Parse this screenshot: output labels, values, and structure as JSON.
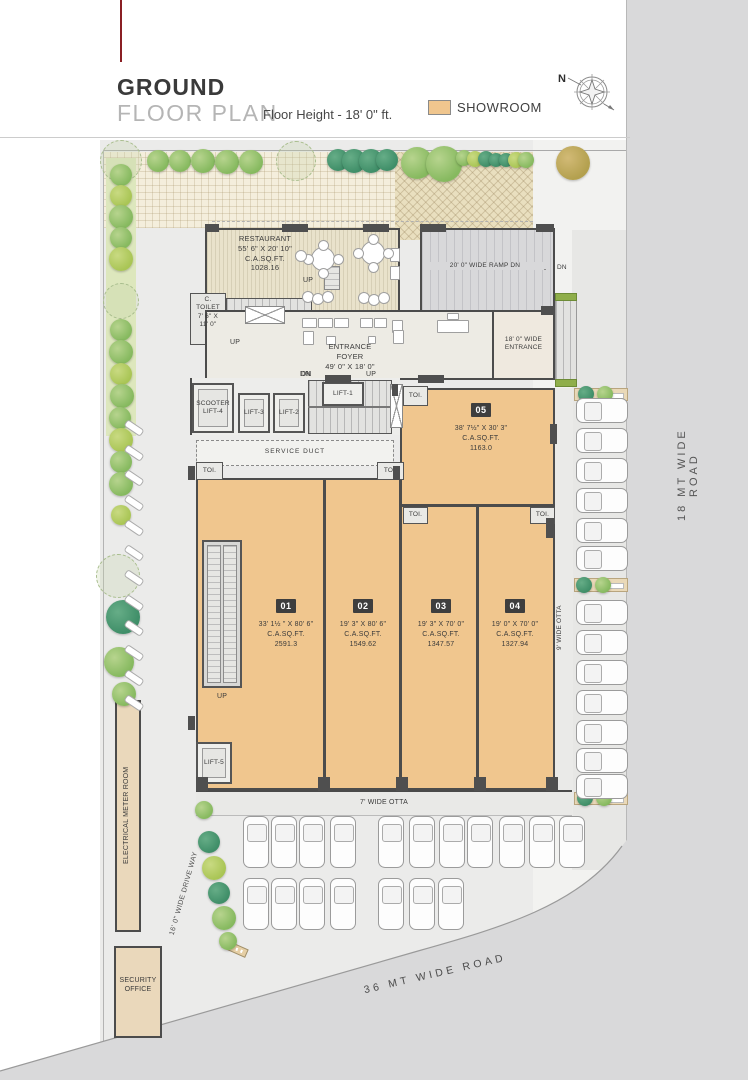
{
  "header": {
    "title_line1": "GROUND",
    "title_line2": "FLOOR PLAN",
    "floor_height": "Floor Height - 18' 0\" ft.",
    "legend_label": "SHOWROOM",
    "legend_color": "#F0C68E",
    "compass_north": "N"
  },
  "rooms": {
    "restaurant": {
      "name": "RESTAURANT",
      "dim": "55' 6\" X 20' 10\"",
      "area_label": "C.A.SQ.FT.",
      "area": "1028.16"
    },
    "toilet_c": {
      "line1": "C.",
      "line2": "TOILET",
      "line3": "7' 6\" X",
      "line4": "11' 0\""
    },
    "entrance_foyer": {
      "line1": "ENTRANCE",
      "line2": "FOYER",
      "dim": "49' 0\" X 18' 0\""
    },
    "wide_entrance": {
      "line1": "18' 0\" WIDE",
      "line2": "ENTRANCE"
    },
    "ramp": {
      "label": "20' 0\" WIDE RAMP DN"
    },
    "scooter_lift": {
      "line1": "SCOOTER",
      "line2": "LIFT-4"
    },
    "lift1": "LIFT-1",
    "lift2": "LIFT-2",
    "lift3": "LIFT-3",
    "lift5": "LIFT-5",
    "service_duct": "SERVICE DUCT",
    "toi": "TOI.",
    "electrical_meter_room": "ELECTRICAL METER ROOM",
    "security": {
      "line1": "SECURITY",
      "line2": "OFFICE"
    }
  },
  "showrooms": [
    {
      "id": "01",
      "dim": "33' 1½ \" X 80' 6\"",
      "area_label": "C.A.SQ.FT.",
      "area": "2591.3"
    },
    {
      "id": "02",
      "dim": "19' 3\" X 80' 6\"",
      "area_label": "C.A.SQ.FT.",
      "area": "1549.62"
    },
    {
      "id": "03",
      "dim": "19' 3\" X 70' 0\"",
      "area_label": "C.A.SQ.FT.",
      "area": "1347.57"
    },
    {
      "id": "04",
      "dim": "19' 0\" X 70' 0\"",
      "area_label": "C.A.SQ.FT.",
      "area": "1327.94"
    },
    {
      "id": "05",
      "dim": "38' 7½\" X 30' 3\"",
      "area_label": "C.A.SQ.FT.",
      "area": "1163.0"
    }
  ],
  "site": {
    "otta7": "7' WIDE OTTA",
    "otta9": "9' WIDE OTTA",
    "driveway": "16' 0\" WIDE DRIVE WAY",
    "road_bottom": "36 MT WIDE ROAD",
    "road_right": "18 MT WIDE ROAD",
    "up": "UP",
    "dn": "DN"
  }
}
